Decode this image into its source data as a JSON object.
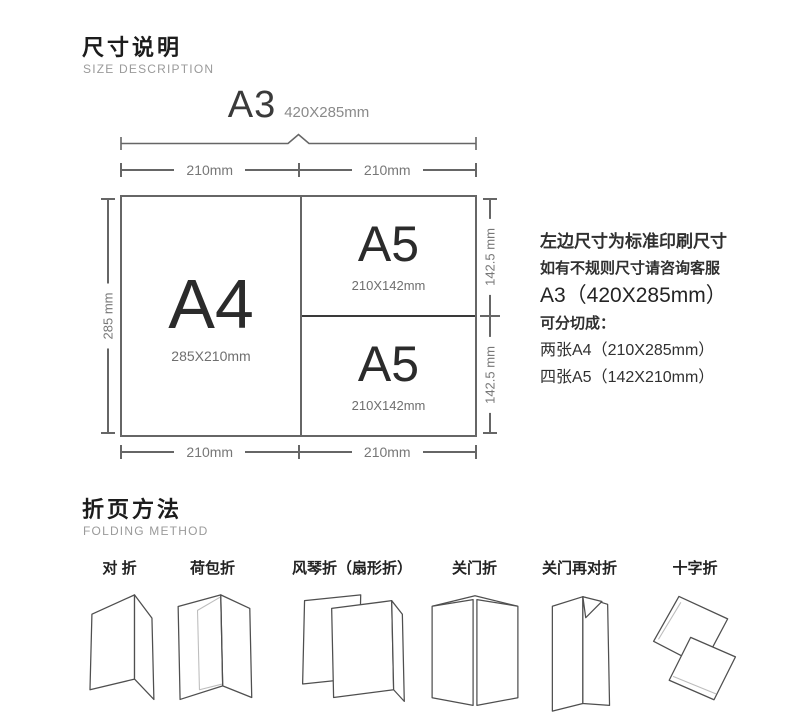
{
  "size_section": {
    "title": "尺寸说明",
    "subtitle": "SIZE DESCRIPTION",
    "a3": {
      "label": "A3",
      "dims": "420X285mm"
    },
    "dims": {
      "top_left": "210mm",
      "top_right": "210mm",
      "bottom_left": "210mm",
      "bottom_right": "210mm",
      "left_side": "285 mm",
      "right_top": "142.5 mm",
      "right_bottom": "142.5 mm"
    },
    "cells": {
      "a4": {
        "label": "A4",
        "dims": "285X210mm"
      },
      "a5_top": {
        "label": "A5",
        "dims": "210X142mm"
      },
      "a5_bottom": {
        "label": "A5",
        "dims": "210X142mm"
      }
    },
    "notes": [
      "左边尺寸为标准印刷尺寸",
      "如有不规则尺寸请咨询客服",
      "A3（420X285mm）",
      "可分切成：",
      "两张A4（210X285mm）",
      "四张A5（142X210mm）"
    ]
  },
  "folding_section": {
    "title": "折页方法",
    "subtitle": "FOLDING METHOD",
    "methods": [
      {
        "label": "对 折",
        "icon": "half-fold-icon"
      },
      {
        "label": "荷包折",
        "icon": "roll-fold-icon"
      },
      {
        "label": "风琴折（扇形折）",
        "icon": "accordion-fold-icon"
      },
      {
        "label": "关门折",
        "icon": "gate-fold-icon"
      },
      {
        "label": "关门再对折",
        "icon": "gate-half-fold-icon"
      },
      {
        "label": "十字折",
        "icon": "cross-fold-icon"
      }
    ]
  },
  "colors": {
    "line": "#666666",
    "text_dark": "#1c1c1c",
    "text_muted": "#8a8a8a"
  }
}
